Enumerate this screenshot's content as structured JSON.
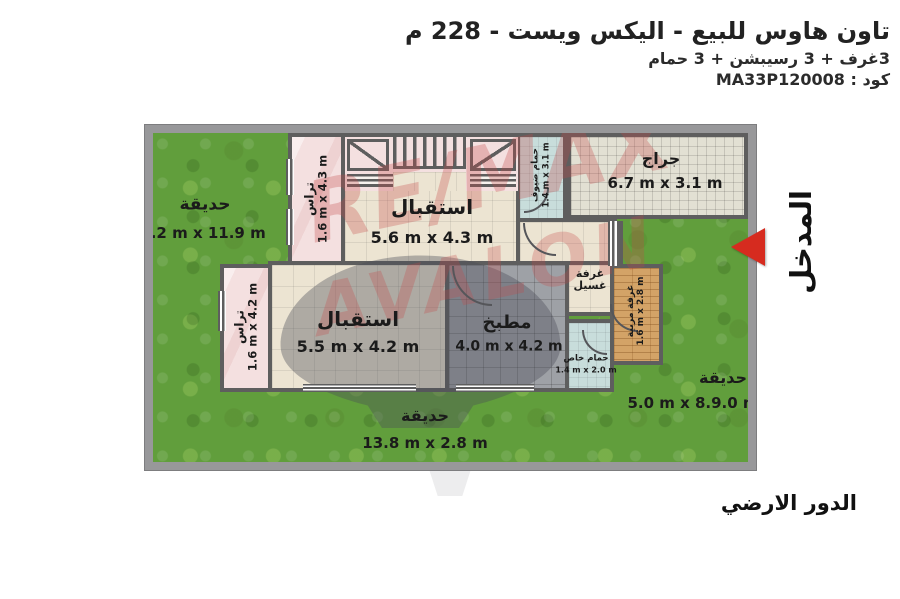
{
  "header": {
    "title": "تاون هاوس للبيع - اليكس ويست - 228 م",
    "subtitle": "3غرف + 3 رسيبشن + 3 حمام",
    "code": "كود : MA33P120008"
  },
  "labels": {
    "entrance": "المدخل",
    "floor": "الدور الارضي"
  },
  "watermark": {
    "line1": "RE/MAX",
    "line2": "AVALON"
  },
  "rooms": {
    "garden_left": {
      "name": "حديقة",
      "dims": "5.2 m x 11.9 m"
    },
    "garden_right": {
      "name": "حديقة",
      "dims": "5.0 m x 8.9.0 m"
    },
    "garden_bottom": {
      "name": "حديقة",
      "dims": "13.8 m x 2.8 m"
    },
    "terrace_1": {
      "name": "تراس",
      "dims": "1.6 m x 4.3 m"
    },
    "terrace_2": {
      "name": "تراس",
      "dims": "1.6 m x 4.2 m"
    },
    "reception_1": {
      "name": "استقبال",
      "dims": "5.6 m x 4.3 m"
    },
    "reception_2": {
      "name": "استقبال",
      "dims": "5.5 m x 4.2 m"
    },
    "garage": {
      "name": "جراج",
      "dims": "6.7 m x 3.1 m"
    },
    "kitchen": {
      "name": "مطبخ",
      "dims": "4.0 m x 4.2 m"
    },
    "guest_bath": {
      "name": "حمام ضيوف",
      "dims": "1.4 m x 3.1 m"
    },
    "private_bath": {
      "name": "حمام خاص",
      "dims": "1.4 m x 2.0 m"
    },
    "laundry": {
      "name": "غرفة غسيل"
    },
    "nanny": {
      "name": "غرفة مربية",
      "dims": "1.6 m x 2.8 m"
    }
  },
  "colors": {
    "garden": "#619e3c",
    "wall": "#5e5e5e",
    "terrace": "#f4e0e0",
    "floor": "#ece4d2",
    "kitchen": "#9ea1a6",
    "bath": "#c8dddb",
    "wood": "#d3a367",
    "garage": "#e2e0d3",
    "arrow_red": "#d62b1f",
    "watermark_red": "rgba(197,72,72,0.30)"
  }
}
